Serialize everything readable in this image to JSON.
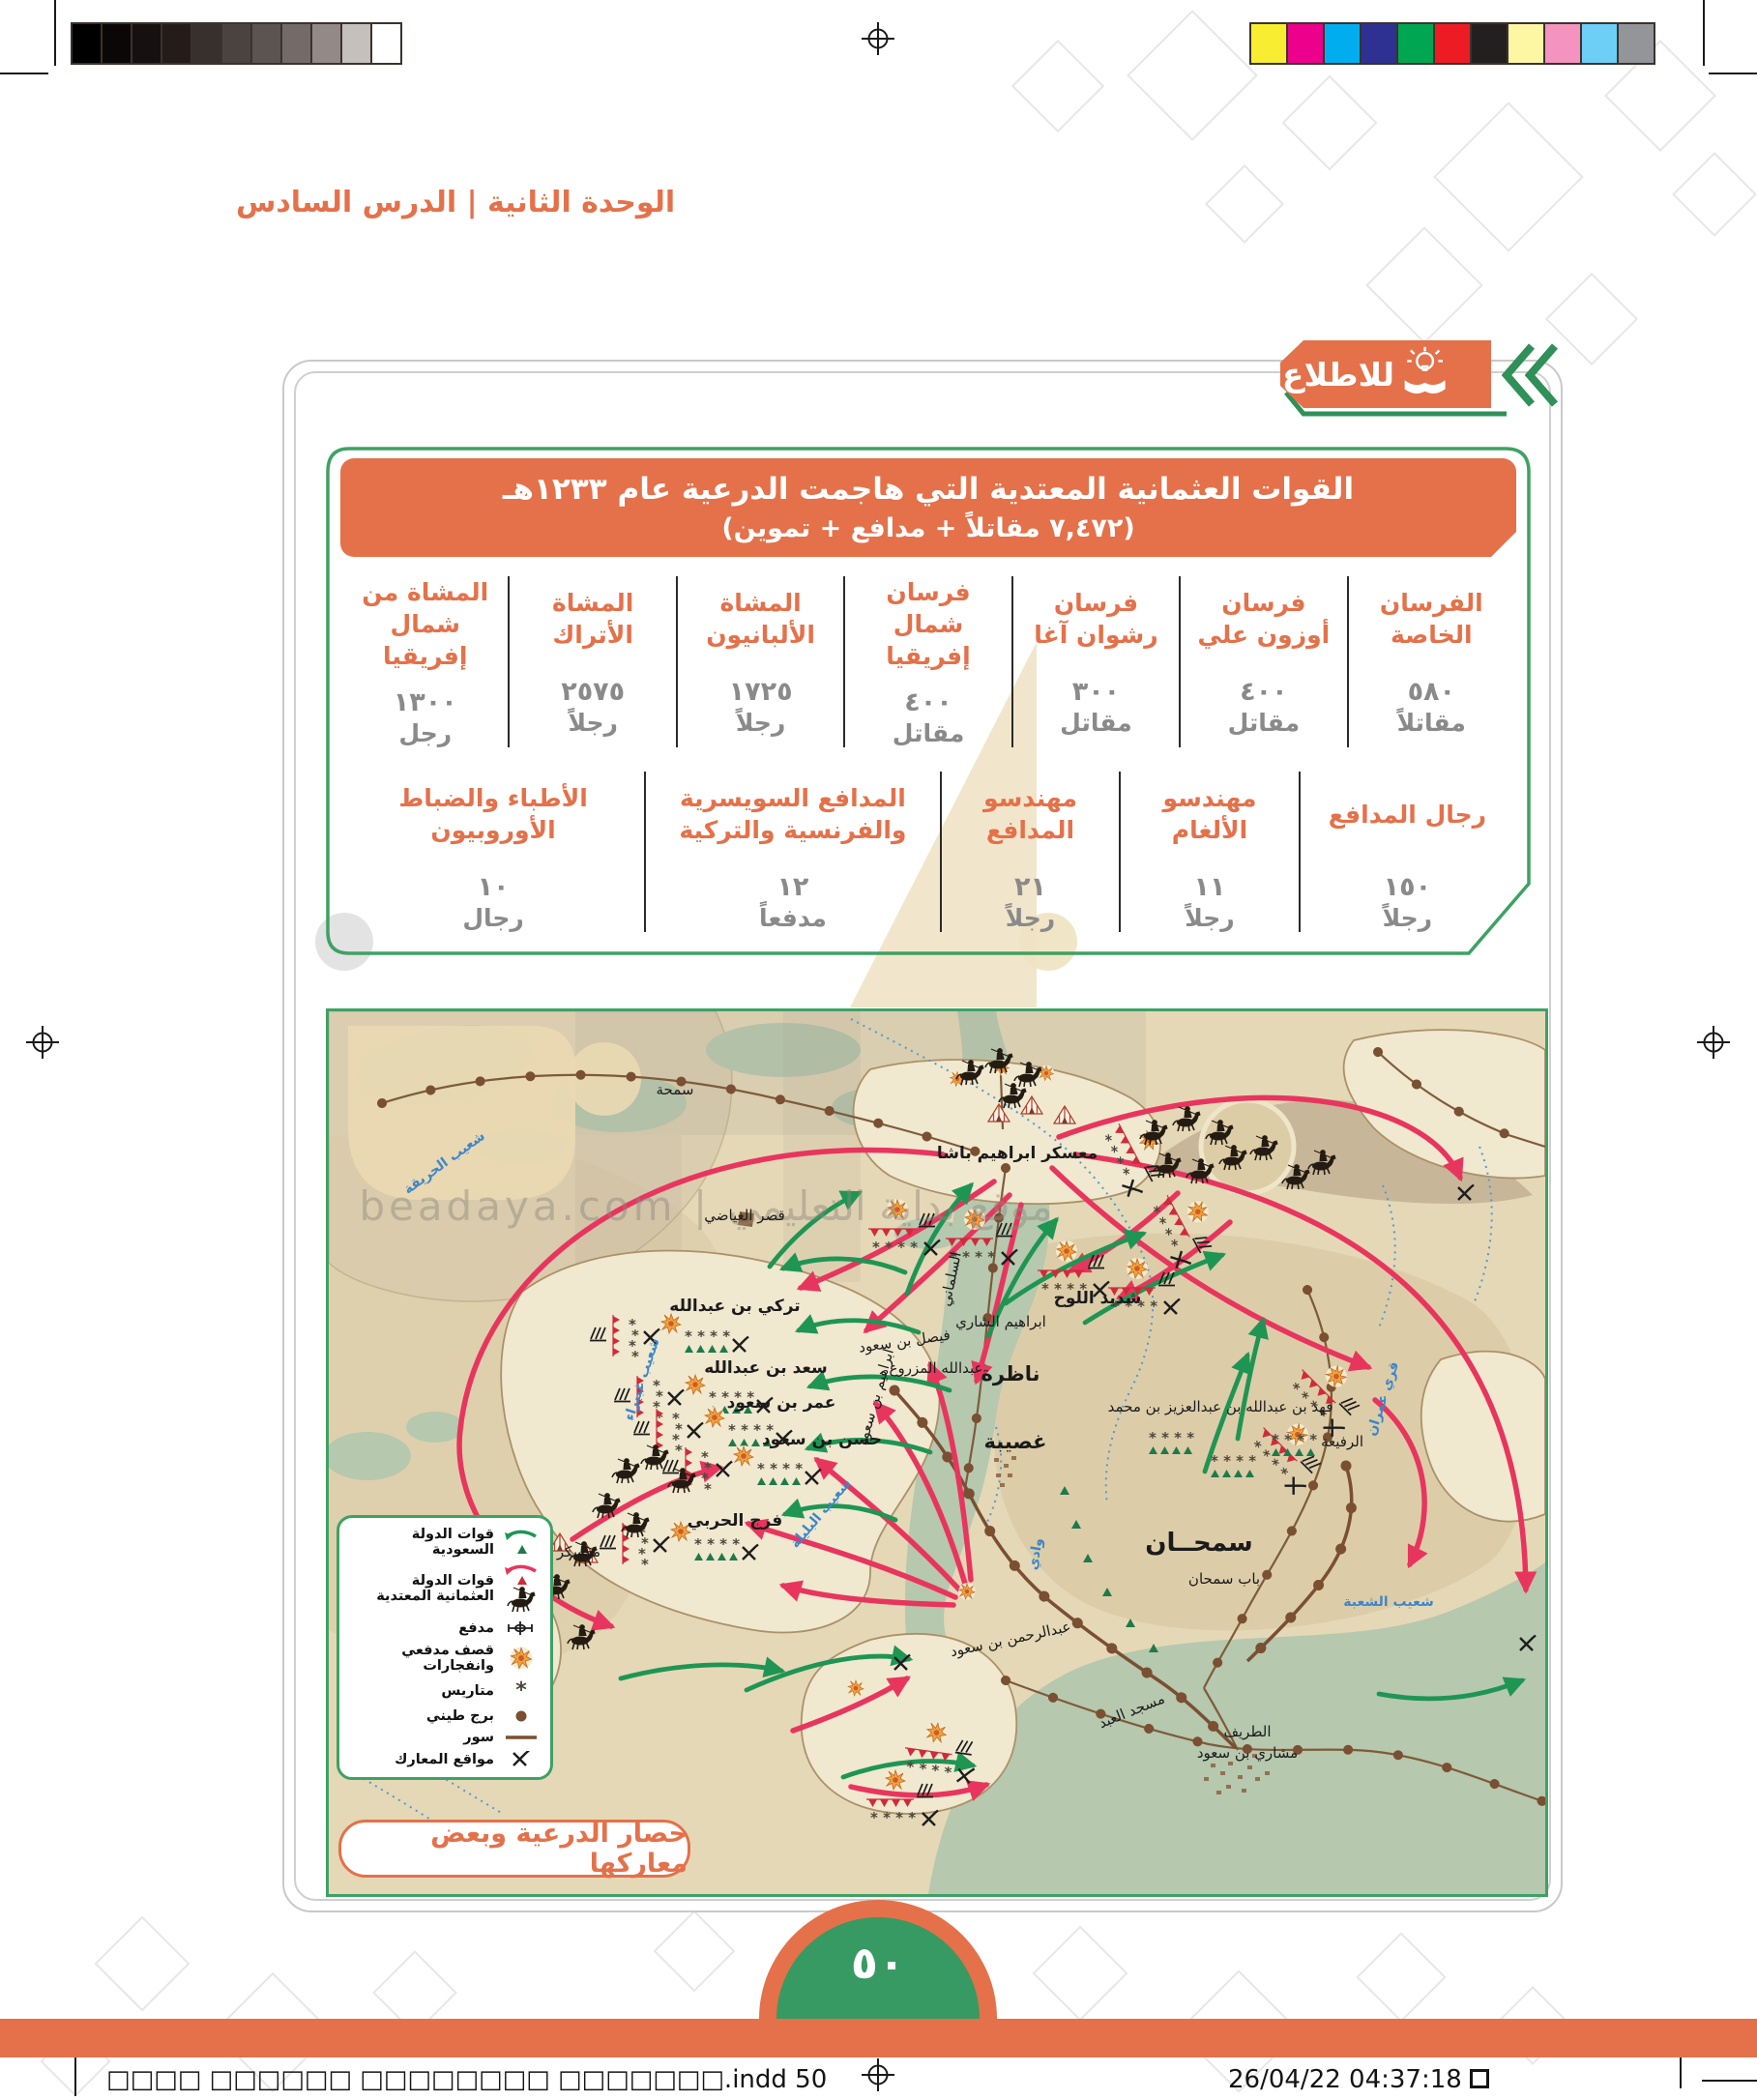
{
  "page": {
    "lesson_header": "الوحدة الثانية | الدرس السادس",
    "info_tab": "للاطلاع",
    "page_number": "٥٠",
    "slug_left": "□□□□ □□□□□□ □□□□□□□□ □□□□□□□.indd   50",
    "slug_right": "26/04/22   04:37:18"
  },
  "print": {
    "grays": [
      "#000000",
      "#0b0707",
      "#171010",
      "#251c1a",
      "#37302d",
      "#4a4340",
      "#5c5451",
      "#746b68",
      "#938a87",
      "#c6c0bd",
      "#ffffff"
    ],
    "colors": [
      "#f9ed32",
      "#ec008c",
      "#00aeef",
      "#2e3192",
      "#00a651",
      "#ed1c24",
      "#231f20",
      "#fdf6a3",
      "#f593c0",
      "#6dcff6",
      "#939598"
    ]
  },
  "table": {
    "title_line1": "القوات العثمانية المعتدية التي هاجمت الدرعية عام ١٢٣٣هـ",
    "title_line2": "(٧,٤٧٢ مقاتلاً + مدافع + تموين)",
    "row1": [
      {
        "label": "الفرسان الخاصة",
        "value": "٥٨٠",
        "unit": "مقاتلاً"
      },
      {
        "label": "فرسان أوزون علي",
        "value": "٤٠٠",
        "unit": "مقاتل"
      },
      {
        "label": "فرسان رشوان آغا",
        "value": "٣٠٠",
        "unit": "مقاتل"
      },
      {
        "label": "فرسان شمال إفريقيا",
        "value": "٤٠٠",
        "unit": "مقاتل"
      },
      {
        "label": "المشاة الألبانيون",
        "value": "١٧٢٥",
        "unit": "رجلاً"
      },
      {
        "label": "المشاة الأتراك",
        "value": "٢٥٧٥",
        "unit": "رجلاً"
      },
      {
        "label": "المشاة من شمال إفريقيا",
        "value": "١٣٠٠",
        "unit": "رجل"
      }
    ],
    "row2": [
      {
        "label": "رجال المدافع",
        "value": "١٥٠",
        "unit": "رجلاً"
      },
      {
        "label": "مهندسو الألغام",
        "value": "١١",
        "unit": "رجلاً"
      },
      {
        "label": "مهندسو المدافع",
        "value": "٢١",
        "unit": "رجلاً"
      },
      {
        "label": "المدافع السويسرية والفرنسية والتركية",
        "value": "١٢",
        "unit": "مدفعاً"
      },
      {
        "label": "الأطباء والضباط الأوروبيون",
        "value": "١٠",
        "unit": "رجال"
      }
    ]
  },
  "map": {
    "caption": "حصار الدرعية وبعض معاركها",
    "watermark": "beadaya.com | موقع بداية التعليمي",
    "legend": [
      {
        "symbol": "green-arrow-triangle",
        "label": "قوات الدولة السعودية"
      },
      {
        "symbol": "red-arrow-horseman",
        "label": "قوات الدولة العثمانية المعتدية"
      },
      {
        "symbol": "cannon",
        "label": "مدفع"
      },
      {
        "symbol": "explosion",
        "label": "قصف مدفعي وانفجارات"
      },
      {
        "symbol": "asterisk",
        "label": "متاريس"
      },
      {
        "symbol": "mud-tower-dot",
        "label": "برج طيني"
      },
      {
        "symbol": "wall-line",
        "label": "سور"
      },
      {
        "symbol": "battle-x",
        "label": "مواقع المعارك"
      }
    ],
    "labels": [
      {
        "text": "سمحة"
      },
      {
        "text": "معسكر ابراهيم باشا"
      },
      {
        "text": "شعيب الحريقة"
      },
      {
        "text": "قصر الغياضي"
      },
      {
        "text": "تركي بن عبدالله"
      },
      {
        "text": "سعد بن عبدالله"
      },
      {
        "text": "عمر بن سعود"
      },
      {
        "text": "حسن بن سعود"
      },
      {
        "text": "فرج الحربي"
      },
      {
        "text": "معسكر أوزون علي"
      },
      {
        "text": "شديد اللوح"
      },
      {
        "text": "ابراهيم الشاري"
      },
      {
        "text": "ناظرة"
      },
      {
        "text": "عبدالله المزروع"
      },
      {
        "text": "فيصل بن سعود"
      },
      {
        "text": "السلماني"
      },
      {
        "text": "غصيبة"
      },
      {
        "text": "شعيب البليلة"
      },
      {
        "text": "شعيب غبيراء"
      },
      {
        "text": "سمحــان"
      },
      {
        "text": "باب سمحان"
      },
      {
        "text": "فهد بن عبدالله بن عبدالعزيز بن محمد"
      },
      {
        "text": "الرفيعة"
      },
      {
        "text": "قري عمران"
      },
      {
        "text": "شعيب الشعبة"
      },
      {
        "text": "عبدالرحمن بن سعود"
      },
      {
        "text": "مسجد العبد"
      },
      {
        "text": "الطريف"
      },
      {
        "text": "مشاري بن سعود"
      },
      {
        "text": "ابراهيم بن سعود"
      },
      {
        "text": "وادي"
      }
    ]
  }
}
